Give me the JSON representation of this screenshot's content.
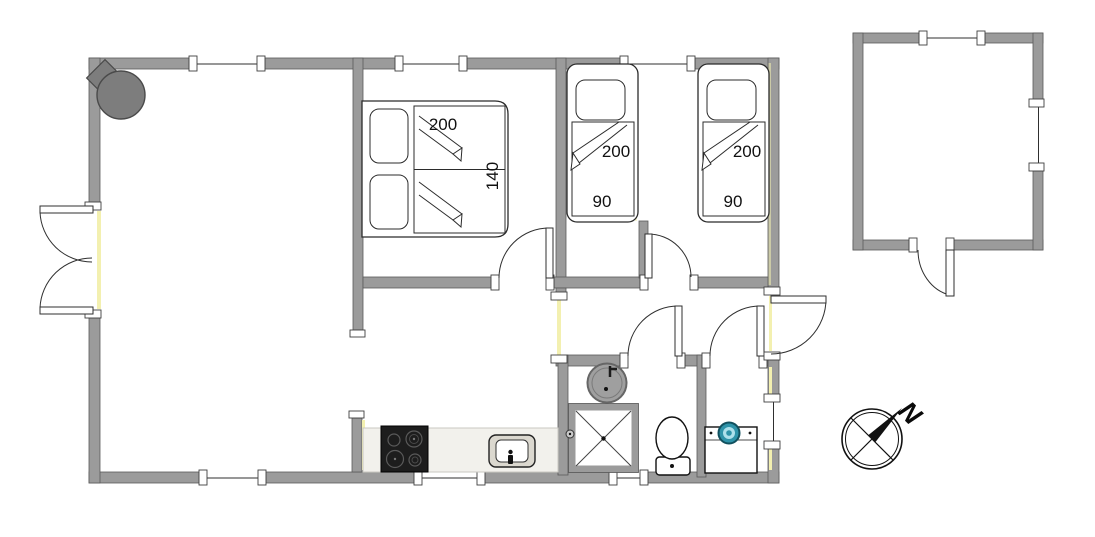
{
  "floor_plan": {
    "beds": {
      "double": {
        "length_cm": "200",
        "width_cm": "140"
      },
      "single_left": {
        "length_cm": "200",
        "width_cm": "90"
      },
      "single_right": {
        "length_cm": "200",
        "width_cm": "90"
      }
    },
    "compass": {
      "north_label": "N"
    },
    "icons": [
      "wood-stove-icon",
      "double-bed-icon",
      "single-bed-icon",
      "washbasin-icon",
      "shower-icon",
      "toilet-icon",
      "washing-machine-icon",
      "cooktop-icon",
      "kitchen-sink-icon",
      "compass-rose-icon"
    ],
    "colors": {
      "wall": "#9b9b9b",
      "wall_outline": "#5a5a5a",
      "accent_yellow": "#f3f0b0",
      "stove": "#7d7d7d",
      "washer_teal": "#2e93a9",
      "washer_teal_light": "#ade0eb",
      "washer_teal_dark": "#11505e",
      "cooktop": "#1d1d1d",
      "counter": "#f2f1ec",
      "sink_gray": "#9f9f9f"
    }
  }
}
